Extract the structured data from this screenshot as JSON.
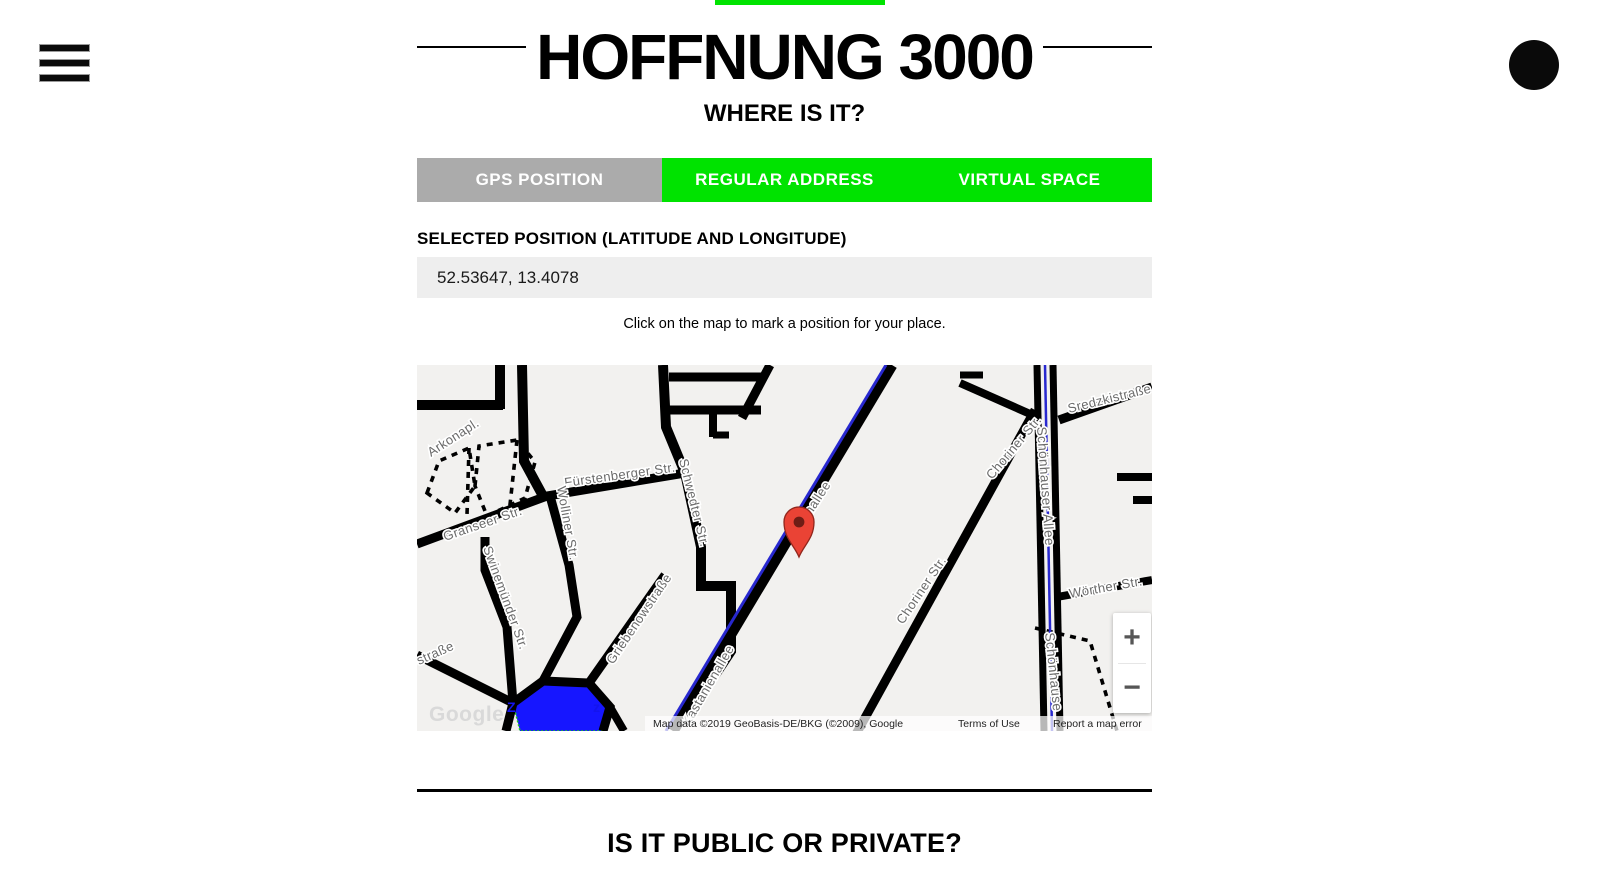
{
  "icons": {
    "menu": "hamburger-icon",
    "avatar": "black-circle-avatar"
  },
  "title": "HOFFNUNG 3000",
  "subtitle": "WHERE IS IT?",
  "tabs": [
    {
      "label": "GPS POSITION",
      "bg": "#ababab",
      "selected": true
    },
    {
      "label": "REGULAR ADDRESS",
      "bg": "#00e300",
      "selected": false
    },
    {
      "label": "VIRTUAL SPACE",
      "bg": "#00e300",
      "selected": false
    }
  ],
  "position_form": {
    "label": "SELECTED POSITION (LATITUDE AND LONGITUDE)",
    "value": "52.53647, 13.4078",
    "hint": "Click on the map to mark a position for your place."
  },
  "map": {
    "logo": "Google",
    "attribution": "Map data ©2019 GeoBasis-DE/BKG (©2009), Google",
    "terms_link": "Terms of Use",
    "report_link": "Report a map error",
    "zoom_in": "+",
    "zoom_out": "−",
    "marker": {
      "lat_lng": "52.53647, 13.4078",
      "x": 382,
      "y": 192
    },
    "park_letters": [
      "Z",
      "z"
    ],
    "labels": [
      {
        "t": "Arkonapl.",
        "x": 14,
        "y": 92,
        "r": -33,
        "s": 13
      },
      {
        "t": "Fürstenberger Str.",
        "x": 148,
        "y": 122,
        "r": -8,
        "s": 13
      },
      {
        "t": "Granseer Str.",
        "x": 28,
        "y": 176,
        "r": -19,
        "s": 13
      },
      {
        "t": "Wolliner Str.",
        "x": 140,
        "y": 122,
        "r": 80,
        "s": 13
      },
      {
        "t": "Schwedter Str.",
        "x": 262,
        "y": 95,
        "r": 76,
        "s": 13
      },
      {
        "t": "Swinemünder Str.",
        "x": 66,
        "y": 183,
        "r": 70,
        "s": 13
      },
      {
        "t": "straße",
        "x": 2,
        "y": 300,
        "r": -24,
        "s": 13
      },
      {
        "t": "Griebenowstraße",
        "x": 196,
        "y": 300,
        "r": -56,
        "s": 13
      },
      {
        "t": "ienallee",
        "x": 388,
        "y": 160,
        "r": -57,
        "s": 13
      },
      {
        "t": "Kastanienallee",
        "x": 272,
        "y": 362,
        "r": -60,
        "s": 13
      },
      {
        "t": "Choriner Str.",
        "x": 575,
        "y": 115,
        "r": -50,
        "s": 13
      },
      {
        "t": "Choriner Str.",
        "x": 486,
        "y": 260,
        "r": -56,
        "s": 13
      },
      {
        "t": "Schönhauser Allee",
        "x": 620,
        "y": 62,
        "r": 86,
        "s": 13.5
      },
      {
        "t": "Schönhause",
        "x": 628,
        "y": 268,
        "r": 84,
        "s": 13.5
      },
      {
        "t": "Sredzkistraße",
        "x": 652,
        "y": 48,
        "r": -14,
        "s": 13
      },
      {
        "t": "Wörther Str.",
        "x": 653,
        "y": 233,
        "r": -10,
        "s": 13
      }
    ],
    "colors": {
      "background": "#f2f1ef",
      "road": "#000000",
      "tram_line": "#2828cf",
      "park_fill": "#1616ff",
      "street_label": "#6b6b6b",
      "marker_red": "#ea4335"
    }
  },
  "bottom": {
    "next_heading": "IS IT PUBLIC OR PRIVATE?"
  },
  "theme": {
    "accent_green": "#00e300",
    "tab_gray": "#ababab",
    "input_bg": "#eeeeee"
  }
}
